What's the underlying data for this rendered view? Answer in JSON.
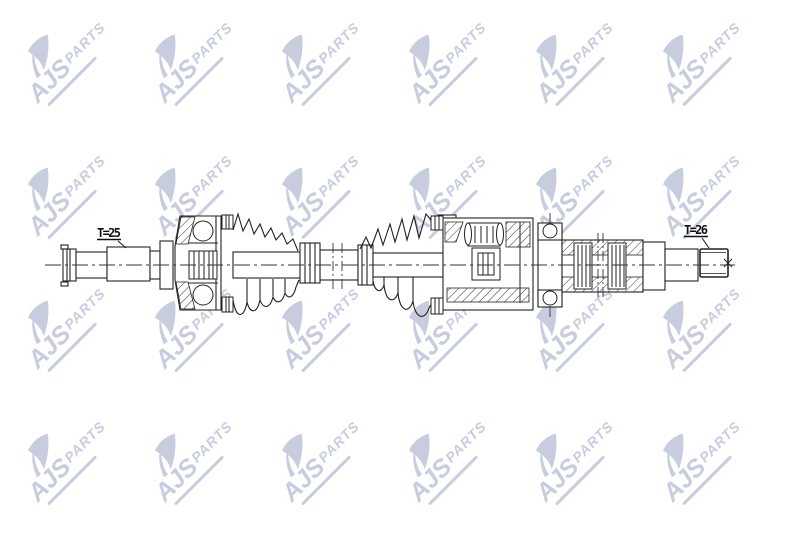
{
  "drawing": {
    "labels": {
      "left_spline_count": "T=25",
      "right_spline_count": "T=26"
    },
    "line_color": "#222222",
    "background": "#ffffff"
  },
  "watermark": {
    "brand": "AJS",
    "suffix": "PARTS",
    "color": "#c8ccdf",
    "grid": {
      "cols": 6,
      "rows": 4
    }
  }
}
